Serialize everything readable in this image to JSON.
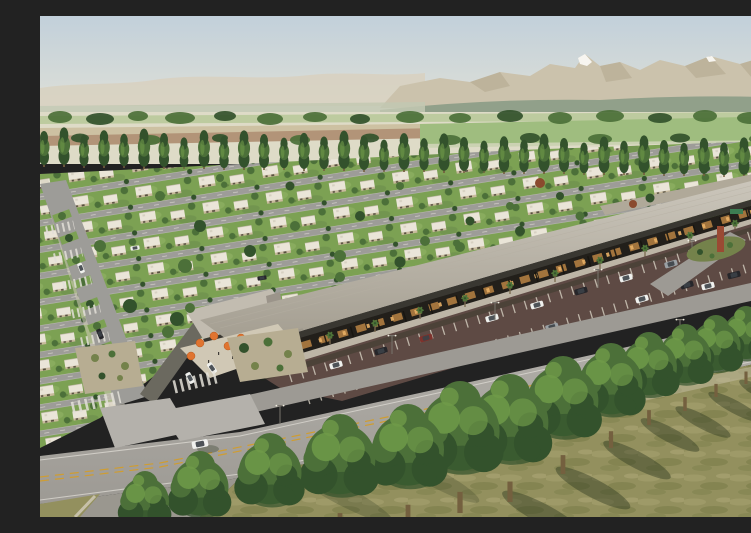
{
  "meta": {
    "type": "architectural-aerial-render",
    "description": "Aerial architectural rendering of a master-planned residential community with a roadside retail strip, surface parking, landscaped boulevards, farmland and mountains on the horizon."
  },
  "regions": {
    "sky": "Hazy morning sky",
    "mountains": "Desert mountain range with snow-capped peak",
    "farmland": "Cultivated fields beyond the community",
    "treeline": "Row of tall poplar trees",
    "residential": "Grid of single-storey courtyard houses with lawns",
    "boulevard": "Tree-lined entry boulevard with median planters",
    "retail_strip": "Retail strip with covered walkway and storefronts",
    "plaza": "Outdoor dining plaza with orange umbrellas",
    "parking": "Angled surface parking lot",
    "access_road": "Service road with landscaped roundabout and sculpture",
    "arterial": "Main arterial road with double yellow centerline",
    "foreground": "Foreground lawn with row of mature trees and long shadows"
  },
  "counts": {
    "poplar_trees": 38,
    "foreground_trees": 14,
    "umbrellas": 6,
    "parked_cars": 14,
    "moving_cars": 9,
    "light_poles": 6,
    "crosswalks": 5,
    "median_islands": 2,
    "plaza_people": 4
  },
  "palette": {
    "sky_top": "#c2d0da",
    "sky_mid": "#d6dbd8",
    "sky_horizon": "#ebe7d9",
    "mountain_far": "#d8d2c2",
    "mountain_main": "#cbc2ac",
    "mountain_shadow": "#b3a78e",
    "snow": "#f7f5f0",
    "foothill": "#91a08a",
    "foothill_pale": "#c2c8b2",
    "field_pale": "#dedbc7",
    "field_green": "#b4c795",
    "field_green2": "#9fbd7f",
    "field_tan": "#cdc1a2",
    "field_brown": "#b29478",
    "canopy_dark": "#33522c",
    "canopy_mid": "#4c7039",
    "canopy_light": "#6f9a49",
    "trunk": "#74603f",
    "lawn": "#7ca153",
    "lawn_light": "#93b468",
    "lawn_dark": "#67884a",
    "house_roof": "#eae5d8",
    "house_wall": "#c9bb9d",
    "house_dark": "#57503f",
    "street": "#9d9c98",
    "street_dark": "#6b695f",
    "road_mark": "#e3e0d8",
    "strip_roof_a": "#cdc8bd",
    "strip_roof_b": "#a29c8f",
    "strip_fascia": "#393731",
    "strip_interior": "#221f1a",
    "strip_glow": "#c38a46",
    "strip_glow2": "#e8b066",
    "plaza": "#d0c8b5",
    "umbrella": "#e07430",
    "parking_surface": "#5e4a44",
    "parking_line": "#d6cfc2",
    "road": "#b4b1ab",
    "road_dark": "#9d9a94",
    "lane_yellow": "#cf9d32",
    "island_tan": "#b7ad92",
    "island_shrub": "#74824b",
    "grass_fg": "#93905e",
    "grass_light": "#aaa371",
    "grass_dark": "#6e743f",
    "shadow_color": "#222e18",
    "car_white": "#f0f1ee",
    "car_black": "#26262a",
    "car_silver": "#9aa0a4",
    "car_red": "#7e322c",
    "car_glass": "#3c4147",
    "sign_red": "#c23b2c",
    "sign_green": "#3d7d52",
    "sculpture": "#9a4a33",
    "palm": "#4e7338",
    "pole": "#78746c"
  }
}
